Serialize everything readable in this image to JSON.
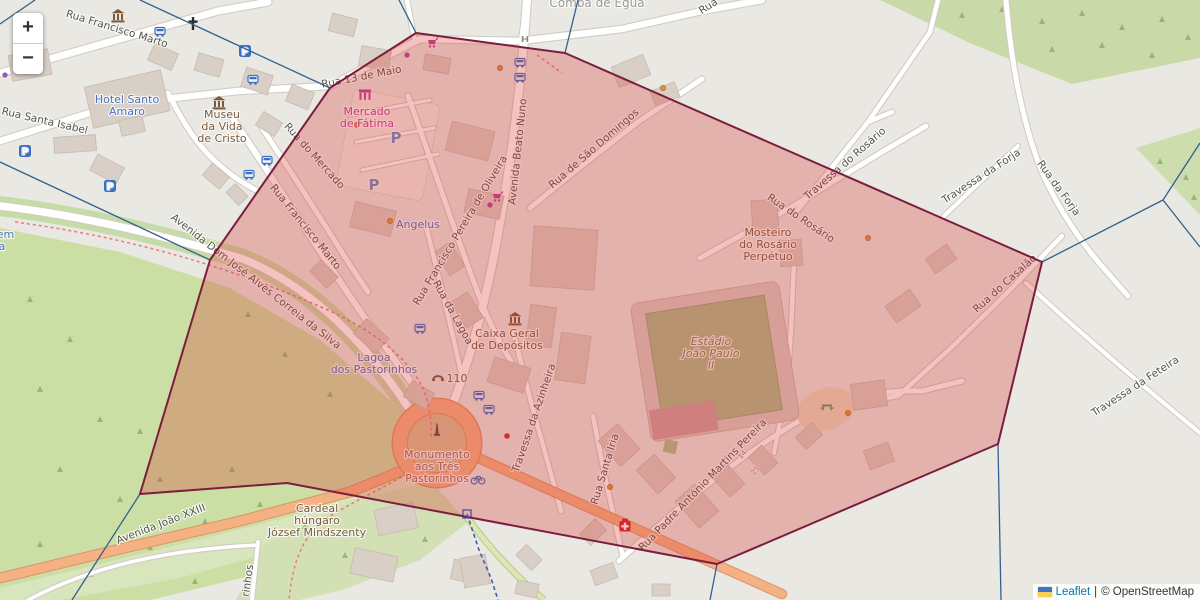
{
  "title": "Leaflet map with highlighted region polygon",
  "zoom_control": {
    "zoom_in": "+",
    "zoom_out": "−"
  },
  "attribution": {
    "flag_icon": "ukraine-flag",
    "leaflet": "Leaflet",
    "separator": "|",
    "copyright": "© OpenStreetMap"
  },
  "overlay": {
    "selected_region": {
      "stroke": "#7b1d3c",
      "fill": "rgba(220,52,48,0.30)",
      "points": [
        [
          416,
          33
        ],
        [
          565,
          53
        ],
        [
          1042,
          262
        ],
        [
          998,
          444
        ],
        [
          717,
          564
        ],
        [
          287,
          483
        ],
        [
          140,
          494
        ],
        [
          210,
          260
        ],
        [
          330,
          88
        ]
      ]
    },
    "boundary_color": "#33618e",
    "neighbor_boundaries": [
      [
        [
          35,
          0
        ],
        [
          0,
          24
        ]
      ],
      [
        [
          140,
          0
        ],
        [
          330,
          88
        ]
      ],
      [
        [
          399,
          0
        ],
        [
          416,
          33
        ]
      ],
      [
        [
          578,
          0
        ],
        [
          565,
          53
        ]
      ],
      [
        [
          0,
          162
        ],
        [
          210,
          260
        ]
      ],
      [
        [
          140,
          494
        ],
        [
          72,
          600
        ]
      ],
      [
        [
          1042,
          262
        ],
        [
          1163,
          200
        ]
      ],
      [
        [
          1163,
          200
        ],
        [
          1200,
          143
        ]
      ],
      [
        [
          1163,
          200
        ],
        [
          1200,
          247
        ]
      ],
      [
        [
          998,
          444
        ],
        [
          1001,
          600
        ]
      ],
      [
        [
          717,
          564
        ],
        [
          710,
          600
        ]
      ]
    ],
    "dashed_route": [
      [
        467,
        514
      ],
      [
        479,
        550
      ],
      [
        491,
        578
      ],
      [
        498,
        600
      ]
    ]
  },
  "street_labels": [
    {
      "text": "Rua Francisco Marto",
      "x": 116,
      "y": 32,
      "r": 17
    },
    {
      "text": "Rua Santa Isabel",
      "x": 44,
      "y": 124,
      "r": 13
    },
    {
      "text": "Rua 13 de Maio",
      "x": 362,
      "y": 80,
      "r": -11
    },
    {
      "text": "Rua do Mercado",
      "x": 312,
      "y": 158,
      "r": 48
    },
    {
      "text": "Rua Francisco Marto",
      "x": 303,
      "y": 229,
      "r": 51
    },
    {
      "text": "Avenida Beato Nuno",
      "x": 521,
      "y": 152,
      "r": -84
    },
    {
      "text": "Rua de São Domingos",
      "x": 596,
      "y": 151,
      "r": -41
    },
    {
      "text": "Rua Francisco Pereira de Oliveira",
      "x": 463,
      "y": 232,
      "r": -59
    },
    {
      "text": "Rua do Rosário",
      "x": 799,
      "y": 221,
      "r": 34
    },
    {
      "text": "Travessa do Rosário",
      "x": 847,
      "y": 166,
      "r": -41
    },
    {
      "text": "Travessa da Forja",
      "x": 983,
      "y": 179,
      "r": -33
    },
    {
      "text": "Rua da Forja",
      "x": 1056,
      "y": 190,
      "r": 54
    },
    {
      "text": "Rua do Casalão",
      "x": 1007,
      "y": 286,
      "r": -42
    },
    {
      "text": "Travessa da Feteira",
      "x": 1137,
      "y": 389,
      "r": -33
    },
    {
      "text": "Rua da Lagoa",
      "x": 450,
      "y": 314,
      "r": 61
    },
    {
      "text": "Travessa da Azinheira",
      "x": 537,
      "y": 419,
      "r": -71
    },
    {
      "text": "Rua Santa Iria",
      "x": 608,
      "y": 470,
      "r": -73
    },
    {
      "text": "Rua Padre António Martins Pereira",
      "x": 705,
      "y": 487,
      "r": -46
    },
    {
      "text": "Avenida Dom José Alves Correia da Silva",
      "x": 254,
      "y": 284,
      "r": 38
    },
    {
      "text": "Avenida João XXIII",
      "x": 162,
      "y": 527,
      "r": -21
    },
    {
      "text": "Rua",
      "x": 710,
      "y": 9,
      "r": -33
    },
    {
      "text": "rinhos",
      "x": 251,
      "y": 581,
      "r": -82
    }
  ],
  "poi_labels": [
    {
      "lines": [
        "Comba de Égua"
      ],
      "x": 597,
      "y": 7,
      "cls": "place"
    },
    {
      "lines": [
        "Hotel Santo",
        "Amaro"
      ],
      "x": 127,
      "y": 103,
      "cls": "blue"
    },
    {
      "lines": [
        "Museu",
        "da Vida",
        "de Cristo"
      ],
      "x": 222,
      "y": 118,
      "cls": "brown"
    },
    {
      "lines": [
        "Mercado",
        "de Fátima"
      ],
      "x": 367,
      "y": 115,
      "cls": "magenta"
    },
    {
      "lines": [
        "Angelus"
      ],
      "x": 418,
      "y": 228,
      "cls": "blue"
    },
    {
      "lines": [
        "Lagoa",
        "dos Pastorinhos"
      ],
      "x": 374,
      "y": 361,
      "cls": "blue"
    },
    {
      "lines": [
        "Caixa Geral",
        "de Depósitos"
      ],
      "x": 507,
      "y": 337,
      "cls": "brown"
    },
    {
      "lines": [
        "Monumento",
        "aos Três",
        "Pastorinhos"
      ],
      "x": 437,
      "y": 458,
      "cls": "rose"
    },
    {
      "lines": [
        "Cardeal",
        "húngaro",
        "József Mindszenty"
      ],
      "x": 317,
      "y": 512,
      "cls": "brown"
    },
    {
      "lines": [
        "Mosteiro",
        "do Rosário",
        "Perpétuo"
      ],
      "x": 768,
      "y": 236,
      "cls": "brown"
    },
    {
      "lines": [
        "Estádio",
        "João Paulo",
        "II"
      ],
      "x": 711,
      "y": 345,
      "cls": "olive"
    },
    {
      "lines": [
        "110"
      ],
      "x": 457,
      "y": 382,
      "cls": "brown",
      "size": 9
    },
    {
      "lines": [
        "gem",
        "a"
      ],
      "x": 2,
      "y": 238,
      "cls": "blue",
      "anchor": "start"
    }
  ],
  "house_numbers": [
    {
      "text": "14",
      "x": 744,
      "y": 456,
      "r": -50
    },
    {
      "text": "25",
      "x": 757,
      "y": 472,
      "r": -50
    }
  ],
  "icons": [
    {
      "t": "parking",
      "x": 245,
      "y": 51
    },
    {
      "t": "parking",
      "x": 25,
      "y": 151
    },
    {
      "t": "parking",
      "x": 110,
      "y": 186
    },
    {
      "t": "pletter",
      "x": 396,
      "y": 138
    },
    {
      "t": "pletter",
      "x": 374,
      "y": 185
    },
    {
      "t": "bus",
      "x": 160,
      "y": 32
    },
    {
      "t": "bus",
      "x": 253,
      "y": 80
    },
    {
      "t": "bus",
      "x": 267,
      "y": 161
    },
    {
      "t": "bus",
      "x": 249,
      "y": 175
    },
    {
      "t": "bus",
      "x": 520,
      "y": 63
    },
    {
      "t": "bus",
      "x": 520,
      "y": 78
    },
    {
      "t": "bus",
      "x": 420,
      "y": 329
    },
    {
      "t": "bus",
      "x": 479,
      "y": 396
    },
    {
      "t": "bus",
      "x": 489,
      "y": 410
    },
    {
      "t": "church",
      "x": 193,
      "y": 24
    },
    {
      "t": "classic",
      "x": 118,
      "y": 16
    },
    {
      "t": "museum",
      "x": 219,
      "y": 103
    },
    {
      "t": "bank",
      "x": 515,
      "y": 319
    },
    {
      "t": "market",
      "x": 365,
      "y": 95
    },
    {
      "t": "cart",
      "x": 432,
      "y": 43
    },
    {
      "t": "cart",
      "x": 497,
      "y": 197
    },
    {
      "t": "pharmacy",
      "x": 625,
      "y": 526
    },
    {
      "t": "monument",
      "x": 437,
      "y": 430
    },
    {
      "t": "bicycle",
      "x": 478,
      "y": 479
    },
    {
      "t": "picnic",
      "x": 827,
      "y": 406
    },
    {
      "t": "phone",
      "x": 438,
      "y": 378
    },
    {
      "t": "gate",
      "x": 525,
      "y": 39
    },
    {
      "t": "odot",
      "x": 500,
      "y": 68
    },
    {
      "t": "odot",
      "x": 357,
      "y": 125
    },
    {
      "t": "odot",
      "x": 390,
      "y": 221
    },
    {
      "t": "odot",
      "x": 663,
      "y": 88
    },
    {
      "t": "odot",
      "x": 868,
      "y": 238
    },
    {
      "t": "odot",
      "x": 610,
      "y": 487
    },
    {
      "t": "odot",
      "x": 848,
      "y": 413
    },
    {
      "t": "mdot",
      "x": 407,
      "y": 55
    },
    {
      "t": "mdot",
      "x": 490,
      "y": 205
    },
    {
      "t": "pdot",
      "x": 22,
      "y": 32
    },
    {
      "t": "pdot",
      "x": 5,
      "y": 75
    },
    {
      "t": "rdot",
      "x": 507,
      "y": 436
    },
    {
      "t": "bstop",
      "x": 467,
      "y": 514
    }
  ]
}
